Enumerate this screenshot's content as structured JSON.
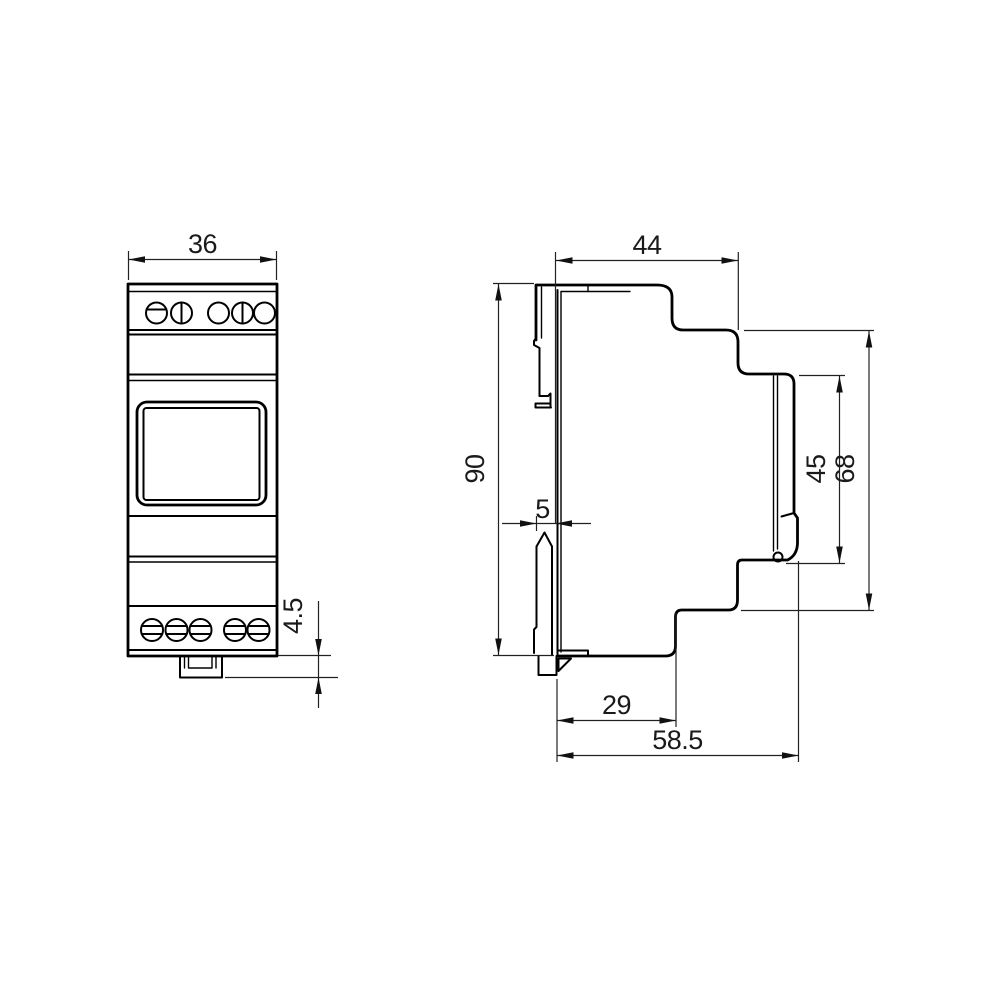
{
  "drawing": {
    "type": "dimensioned technical drawing, DIN-rail device, two orthographic views",
    "background_color": "#ffffff",
    "line_color": "#000000",
    "front": {
      "dimensions": {
        "width_mm": "36",
        "din_tab_mm": "4.5"
      }
    },
    "side": {
      "dimensions": {
        "top_depth_mm": "44",
        "height_mm": "90",
        "clip_width_mm": "5",
        "cover_height_mm": "45",
        "body_height_mm": "68",
        "base_depth_mm": "29",
        "total_depth_mm": "58.5"
      }
    }
  }
}
